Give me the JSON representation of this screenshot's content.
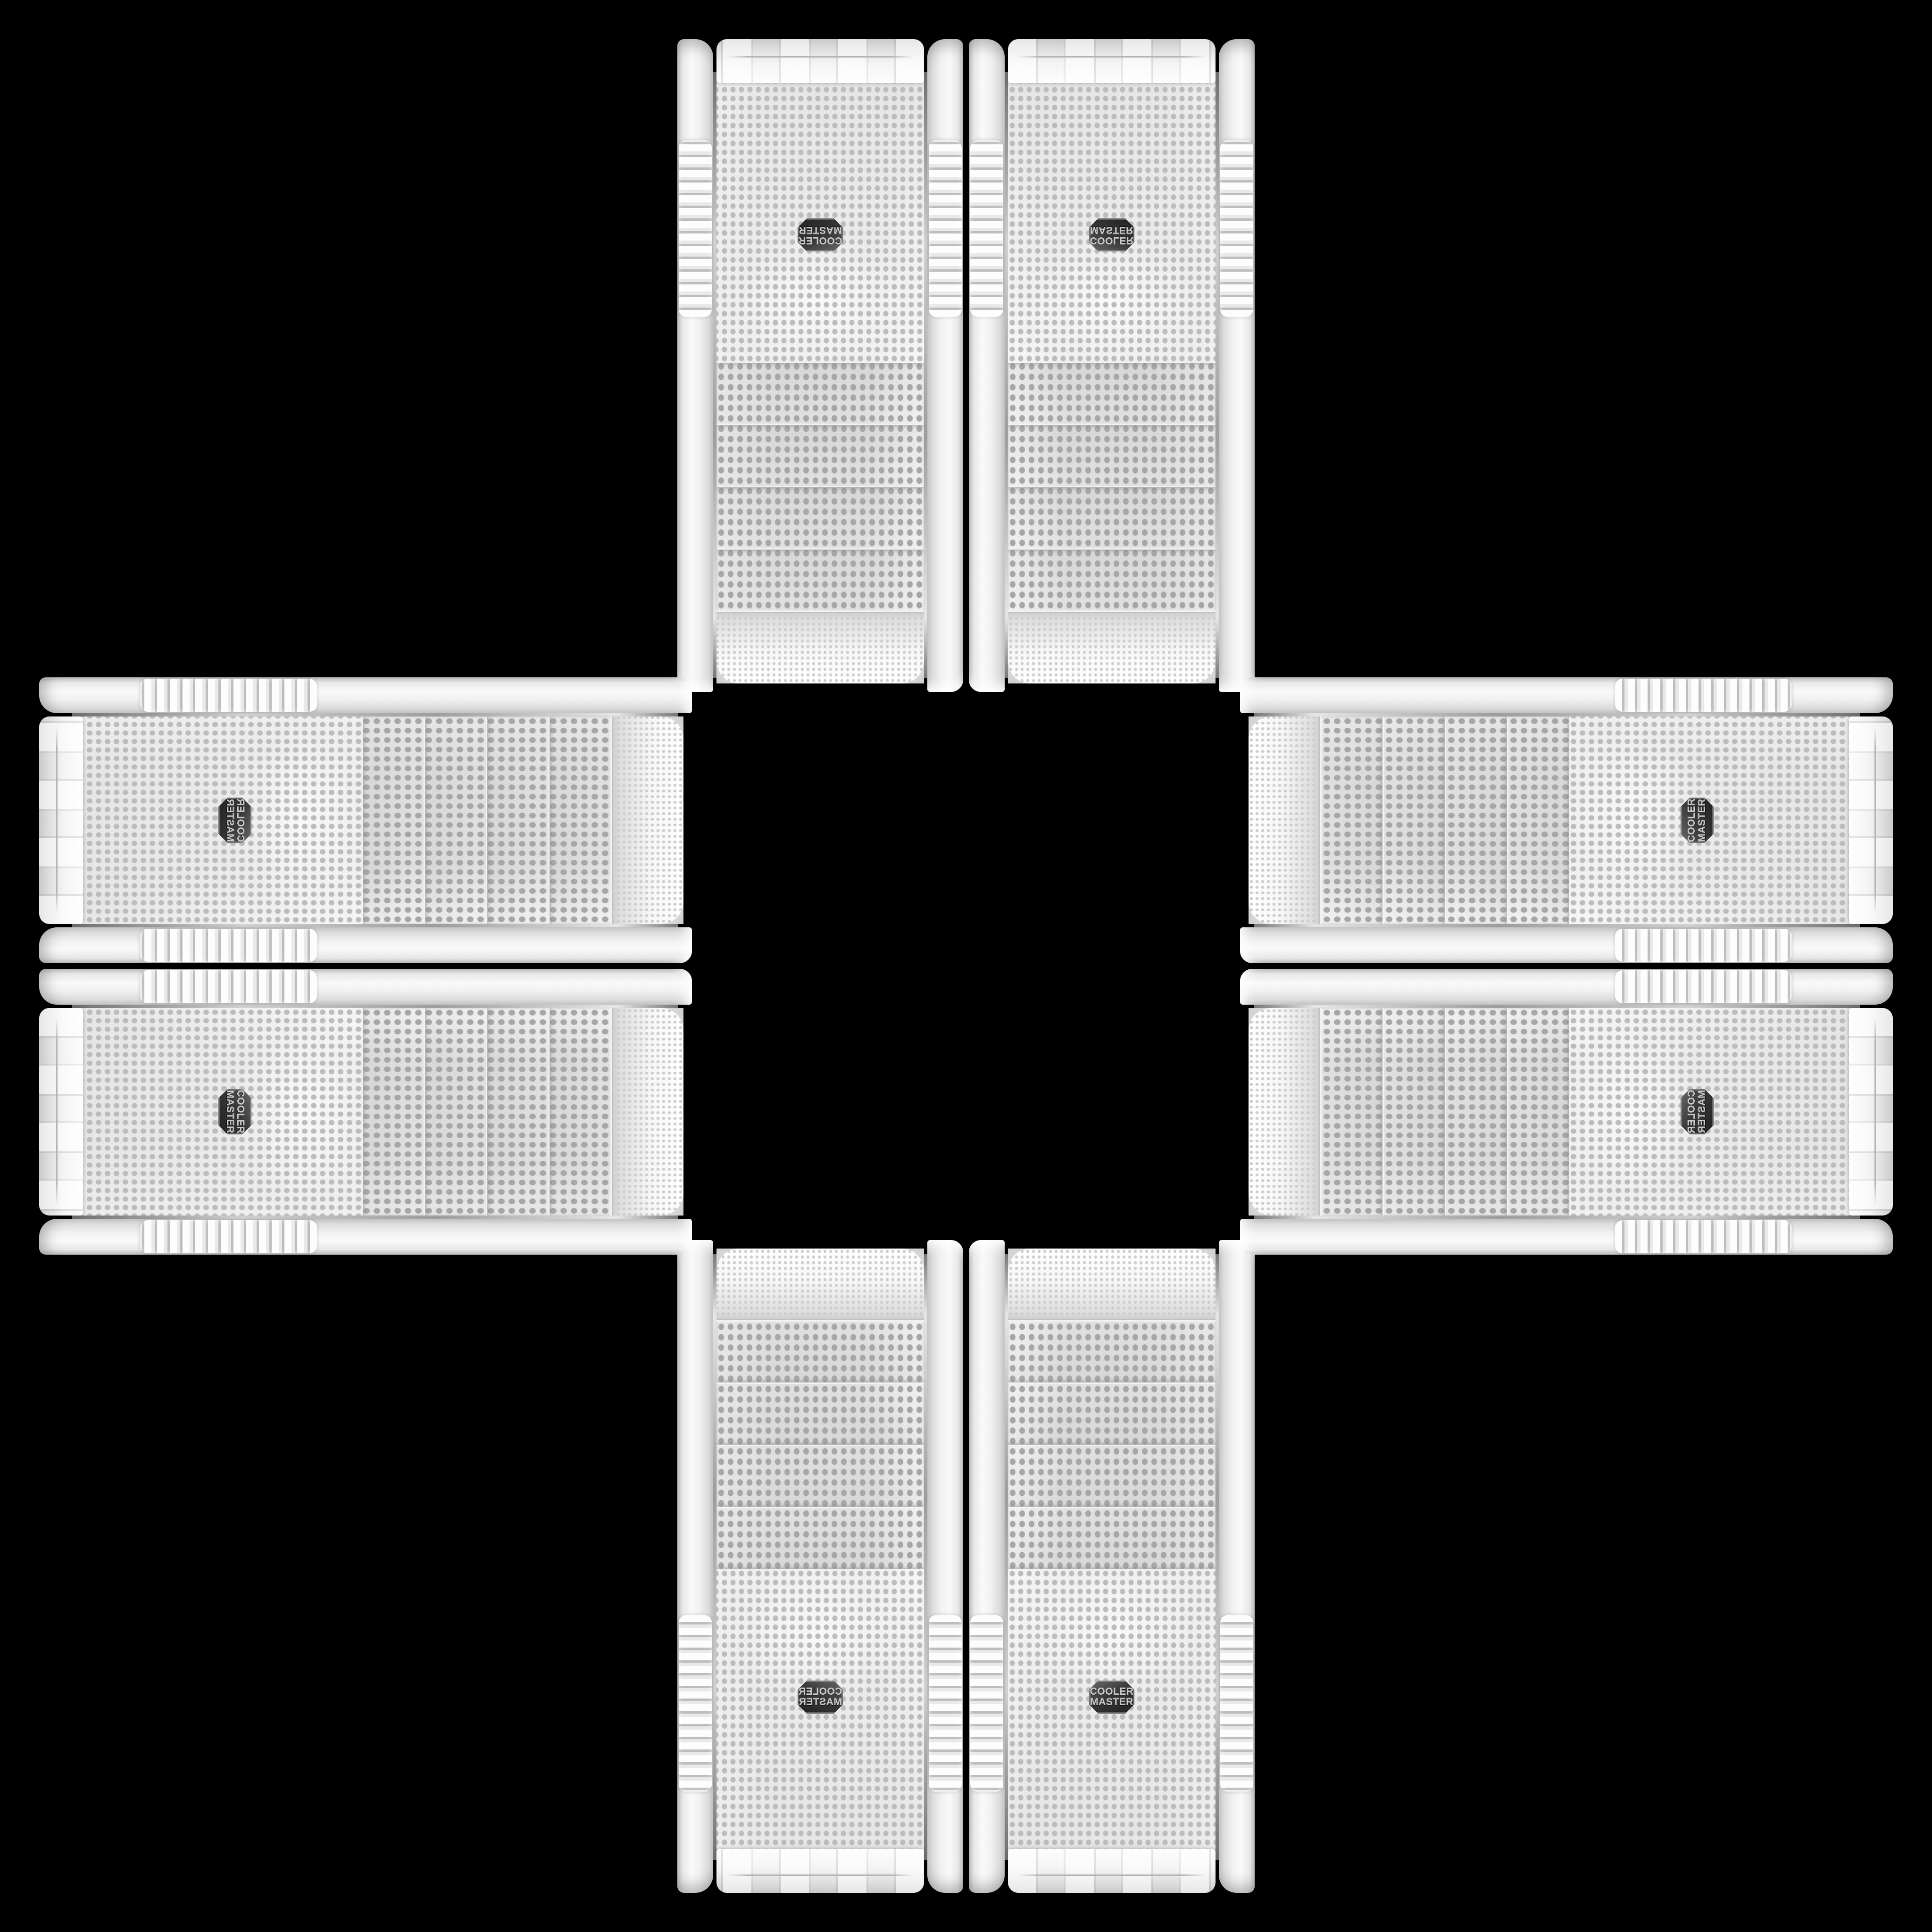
{
  "scene": {
    "background_color": "#000000",
    "arrangement": "cross-collage",
    "case_count": 8,
    "groups": {
      "top_vertical_pair": 2,
      "bottom_vertical_pair": 2,
      "left_horizontal_pair": 2,
      "right_horizontal_pair": 2
    }
  },
  "brand": {
    "line1": "COOLER",
    "line2": "MASTER"
  },
  "case": {
    "body_color": "#f2f2f2",
    "mesh_color": "#e7e7e7",
    "mesh_dot_color": "#bcbcbc",
    "bay_dot_color": "#a7a7a7",
    "chrome_color": "#9d9d9d",
    "drive_bay_cover_count": 4,
    "badge_background": "#383838",
    "badge_text_color": "#c9c9c9"
  }
}
